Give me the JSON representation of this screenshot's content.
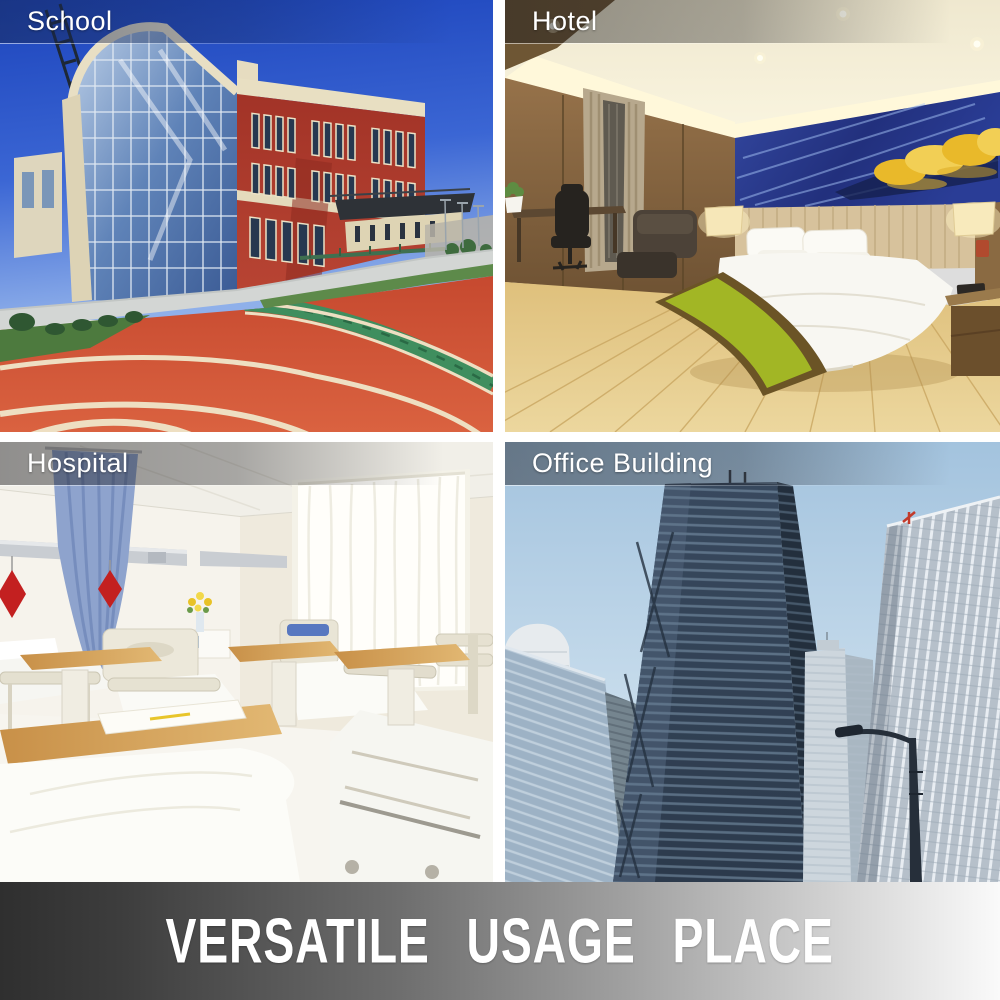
{
  "banner": {
    "text": "VERSATILE USAGE PLACE"
  },
  "panels": [
    {
      "id": "school",
      "label": "School",
      "alt": "red brick school building with curved glass atrium and red running track"
    },
    {
      "id": "hotel",
      "label": "Hotel",
      "alt": "hotel bedroom with white bed, green runner, wood floor and blue wall art"
    },
    {
      "id": "hospital",
      "label": "Hospital",
      "alt": "bright hospital ward with beds, overbed tables, blue curtain and sheer window"
    },
    {
      "id": "office",
      "label": "Office Building",
      "alt": "low-angle view of glass and steel skyscrapers against a blue sky"
    }
  ],
  "colors": {
    "banner_dark": "#2f2f2f",
    "banner_light": "#fafafa",
    "banner_text": "#ffffff",
    "label_text": "#ffffff",
    "track_red": "#cf4a32",
    "lane_cream": "#eedfc2",
    "infield_green": "#3f8e5e",
    "sky_deep_blue": "#1c44bc",
    "runner_green": "#a2b625",
    "art_blue": "#2a3d96",
    "curtain_blue": "#8ea3cd",
    "office_sky": "#a3c3de",
    "gap_white": "#ffffff"
  }
}
